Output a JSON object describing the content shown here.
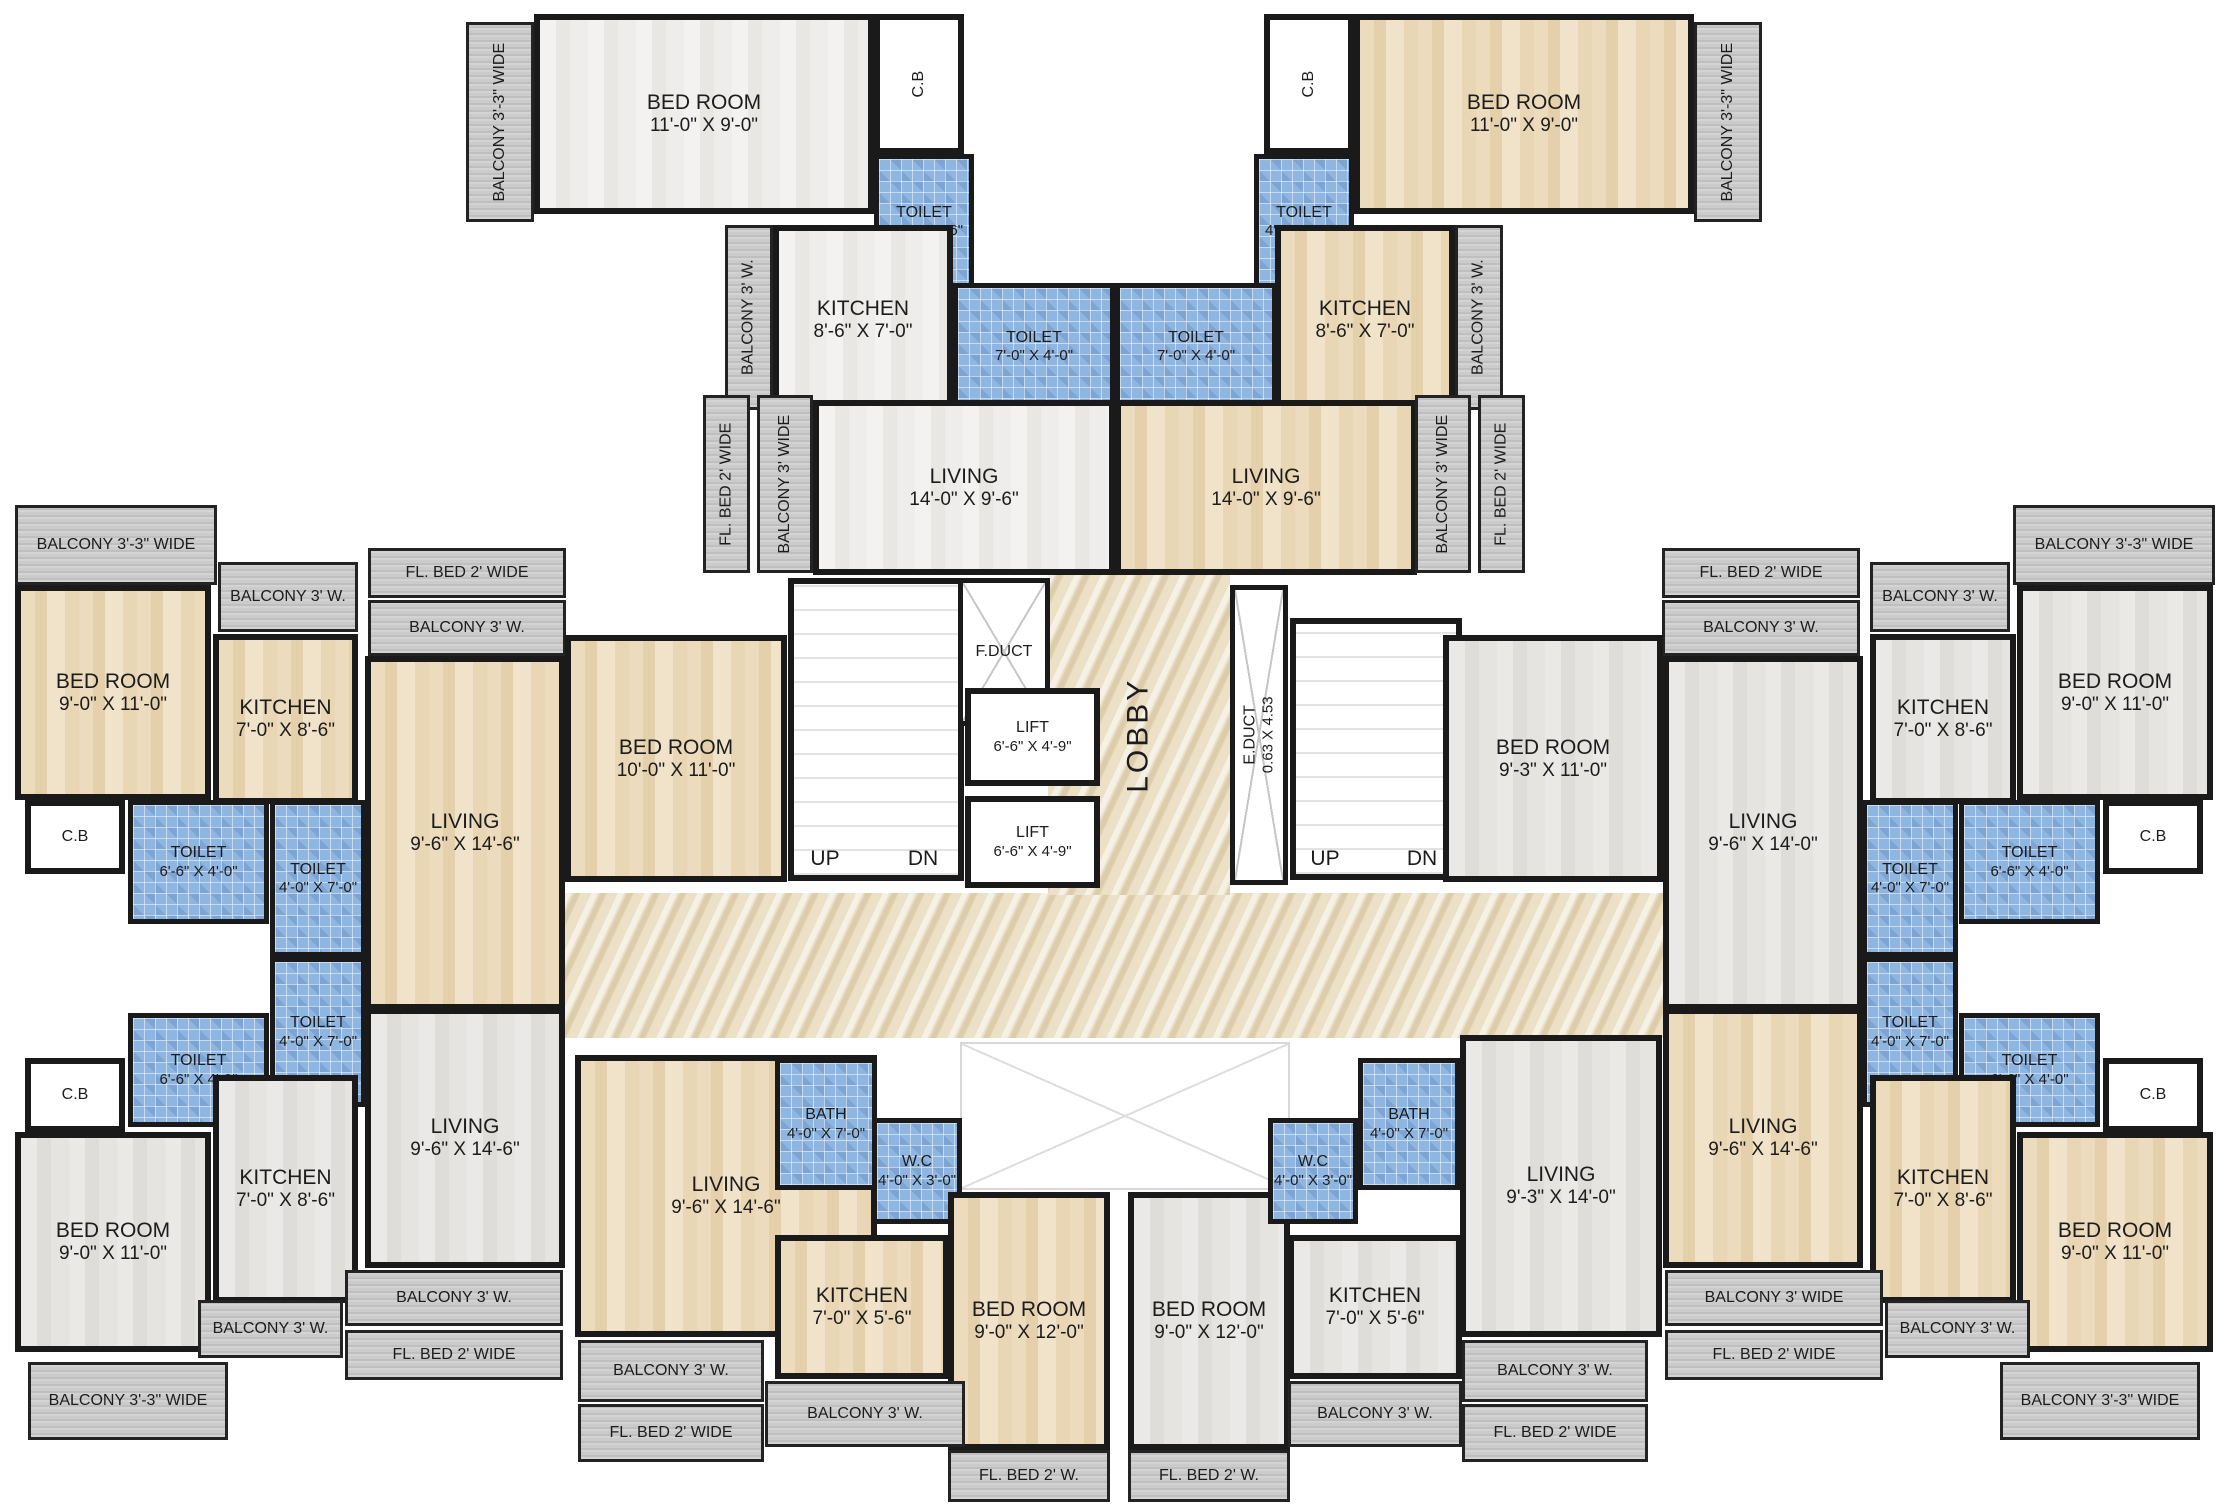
{
  "plan": {
    "width": 2229,
    "height": 1509,
    "type": "residential-building-floor-plan"
  },
  "colors": {
    "wall": "#1a1a1a",
    "wood_floor": "#e8d6b4",
    "tile_light_floor": "#eeedea",
    "tile_gray_floor": "#e4e2df",
    "toilet_blue": "#8fb6e0",
    "balcony_gray": "#c6c6c6",
    "lobby_marble": "#ece0c6"
  },
  "rooms": [
    {
      "name": "lobby-corridor",
      "label": "",
      "dims": "",
      "x": 565,
      "y": 893,
      "w": 1100,
      "h": 145,
      "floor": "marble"
    },
    {
      "name": "lobby",
      "label": "LOBBY",
      "dims": "",
      "x": 1048,
      "y": 575,
      "w": 182,
      "h": 320,
      "floor": "marble",
      "rot": true,
      "size": "lob"
    },
    {
      "name": "staircase-left",
      "label": "",
      "dims": "",
      "x": 788,
      "y": 578,
      "w": 176,
      "h": 303,
      "floor": "stairs"
    },
    {
      "name": "staircase-right",
      "label": "",
      "dims": "",
      "x": 1290,
      "y": 618,
      "w": 172,
      "h": 262,
      "floor": "stairs"
    },
    {
      "name": "f-duct",
      "label": "F.DUCT",
      "dims": "",
      "x": 958,
      "y": 578,
      "w": 92,
      "h": 148,
      "floor": "duct",
      "size": "sm"
    },
    {
      "name": "e-duct",
      "label": "E.DUCT",
      "dims": "0.63 X 4.53",
      "x": 1230,
      "y": 585,
      "w": 58,
      "h": 300,
      "floor": "duct",
      "rot": true,
      "size": "sm"
    },
    {
      "name": "open-cut",
      "label": "",
      "dims": "",
      "x": 960,
      "y": 1042,
      "w": 330,
      "h": 148,
      "floor": "void"
    },
    {
      "name": "lift-1",
      "label": "LIFT",
      "dims": "6'-6\" X 4'-9\"",
      "x": 965,
      "y": 688,
      "w": 135,
      "h": 98,
      "floor": "white",
      "size": "sm"
    },
    {
      "name": "lift-2",
      "label": "LIFT",
      "dims": "6'-6\" X 4'-9\"",
      "x": 965,
      "y": 796,
      "w": 135,
      "h": 92,
      "floor": "white",
      "size": "sm"
    },
    {
      "name": "balcony-33-top-left",
      "label": "BALCONY 3'-3\" WIDE",
      "dims": "",
      "x": 466,
      "y": 22,
      "w": 68,
      "h": 200,
      "floor": "balc",
      "rot": true,
      "size": "sm"
    },
    {
      "name": "bedroom-top-left",
      "label": "BED ROOM",
      "dims": "11'-0\" X 9'-0\"",
      "x": 534,
      "y": 14,
      "w": 340,
      "h": 200,
      "floor": "tileLight"
    },
    {
      "name": "cb-top-left",
      "label": "C.B",
      "dims": "",
      "x": 874,
      "y": 14,
      "w": 90,
      "h": 140,
      "floor": "white",
      "rot": true,
      "size": "sm"
    },
    {
      "name": "toilet-46-top-left",
      "label": "TOILET",
      "dims": "4'-0\" X 6'-6\"",
      "x": 874,
      "y": 154,
      "w": 100,
      "h": 135,
      "floor": "blue",
      "size": "sm"
    },
    {
      "name": "balcony-3w-top-left",
      "label": "BALCONY 3' W.",
      "dims": "",
      "x": 725,
      "y": 225,
      "w": 48,
      "h": 185,
      "floor": "balc",
      "rot": true,
      "size": "sm"
    },
    {
      "name": "kitchen-top-left",
      "label": "KITCHEN",
      "dims": "8'-6\" X 7'-0\"",
      "x": 773,
      "y": 225,
      "w": 180,
      "h": 190,
      "floor": "tileLight"
    },
    {
      "name": "toilet-74-top-left",
      "label": "TOILET",
      "dims": "7'-0\" X 4'-0\"",
      "x": 953,
      "y": 283,
      "w": 162,
      "h": 127,
      "floor": "blue",
      "size": "sm"
    },
    {
      "name": "flbed-top-left",
      "label": "FL. BED 2' WIDE",
      "dims": "",
      "x": 703,
      "y": 395,
      "w": 47,
      "h": 178,
      "floor": "balc",
      "rot": true,
      "size": "sm"
    },
    {
      "name": "balcony-3wide-top-left",
      "label": "BALCONY 3' WIDE",
      "dims": "",
      "x": 757,
      "y": 395,
      "w": 56,
      "h": 178,
      "floor": "balc",
      "rot": true,
      "size": "sm"
    },
    {
      "name": "living-top-left",
      "label": "LIVING",
      "dims": "14'-0\" X 9'-6\"",
      "x": 813,
      "y": 400,
      "w": 302,
      "h": 175,
      "floor": "tileLight"
    },
    {
      "name": "toilet-46-top-right",
      "label": "TOILET",
      "dims": "4'-0\" X 6'-6\"",
      "x": 1254,
      "y": 154,
      "w": 100,
      "h": 135,
      "floor": "blue",
      "size": "sm"
    },
    {
      "name": "cb-top-right",
      "label": "C.B",
      "dims": "",
      "x": 1264,
      "y": 14,
      "w": 90,
      "h": 140,
      "floor": "white",
      "rot": true,
      "size": "sm"
    },
    {
      "name": "bedroom-top-right",
      "label": "BED ROOM",
      "dims": "11'-0\" X 9'-0\"",
      "x": 1354,
      "y": 14,
      "w": 340,
      "h": 200,
      "floor": "wood"
    },
    {
      "name": "balcony-33-top-right",
      "label": "BALCONY 3'-3\" WIDE",
      "dims": "",
      "x": 1694,
      "y": 22,
      "w": 68,
      "h": 200,
      "floor": "balc",
      "rot": true,
      "size": "sm"
    },
    {
      "name": "toilet-74-top-right",
      "label": "TOILET",
      "dims": "7'-0\" X 4'-0\"",
      "x": 1115,
      "y": 283,
      "w": 162,
      "h": 127,
      "floor": "blue",
      "size": "sm"
    },
    {
      "name": "kitchen-top-right",
      "label": "KITCHEN",
      "dims": "8'-6\" X 7'-0\"",
      "x": 1275,
      "y": 225,
      "w": 180,
      "h": 190,
      "floor": "wood"
    },
    {
      "name": "balcony-3w-top-right",
      "label": "BALCONY 3' W.",
      "dims": "",
      "x": 1455,
      "y": 225,
      "w": 48,
      "h": 185,
      "floor": "balc",
      "rot": true,
      "size": "sm"
    },
    {
      "name": "living-top-right",
      "label": "LIVING",
      "dims": "14'-0\" X 9'-6\"",
      "x": 1115,
      "y": 400,
      "w": 302,
      "h": 175,
      "floor": "wood"
    },
    {
      "name": "balcony-3wide-top-right",
      "label": "BALCONY 3' WIDE",
      "dims": "",
      "x": 1415,
      "y": 395,
      "w": 56,
      "h": 178,
      "floor": "balc",
      "rot": true,
      "size": "sm"
    },
    {
      "name": "flbed-top-right",
      "label": "FL. BED 2' WIDE",
      "dims": "",
      "x": 1478,
      "y": 395,
      "w": 47,
      "h": 178,
      "floor": "balc",
      "rot": true,
      "size": "sm"
    },
    {
      "name": "balcony-33-left-top",
      "label": "BALCONY 3'-3\"  WIDE",
      "dims": "",
      "x": 15,
      "y": 505,
      "w": 202,
      "h": 80,
      "floor": "balc",
      "size": "sm"
    },
    {
      "name": "balcony-3w-left-top",
      "label": "BALCONY 3' W.",
      "dims": "",
      "x": 218,
      "y": 562,
      "w": 140,
      "h": 70,
      "floor": "balc",
      "size": "sm"
    },
    {
      "name": "flbed-left-top",
      "label": "FL. BED 2'  WIDE",
      "dims": "",
      "x": 368,
      "y": 548,
      "w": 198,
      "h": 50,
      "floor": "balc",
      "size": "sm"
    },
    {
      "name": "balcony-3w-left-top-2",
      "label": "BALCONY 3' W.",
      "dims": "",
      "x": 368,
      "y": 600,
      "w": 198,
      "h": 56,
      "floor": "balc",
      "size": "sm"
    },
    {
      "name": "bedroom-left-top",
      "label": "BED ROOM",
      "dims": "9'-0\" X 11'-0\"",
      "x": 15,
      "y": 585,
      "w": 196,
      "h": 215,
      "floor": "wood"
    },
    {
      "name": "kitchen-left-top",
      "label": "KITCHEN",
      "dims": "7'-0\" X 8'-6\"",
      "x": 213,
      "y": 634,
      "w": 145,
      "h": 170,
      "floor": "wood"
    },
    {
      "name": "living-left-mid",
      "label": "LIVING",
      "dims": "9'-6\" X 14'-6\"",
      "x": 365,
      "y": 656,
      "w": 200,
      "h": 354,
      "floor": "wood"
    },
    {
      "name": "bedroom-10x11-left-mid",
      "label": "BED ROOM",
      "dims": "10'-0\" X 11'-0\"",
      "x": 565,
      "y": 635,
      "w": 222,
      "h": 247,
      "floor": "wood"
    },
    {
      "name": "cb-left-top",
      "label": "C.B",
      "dims": "",
      "x": 25,
      "y": 800,
      "w": 100,
      "h": 74,
      "floor": "white",
      "size": "sm"
    },
    {
      "name": "toilet-66-left-top",
      "label": "TOILET",
      "dims": "6'-6\" X 4'-0\"",
      "x": 128,
      "y": 800,
      "w": 141,
      "h": 124,
      "floor": "blue",
      "size": "sm"
    },
    {
      "name": "toilet-47-left-top",
      "label": "TOILET",
      "dims": "4'-0\" X 7'-0\"",
      "x": 270,
      "y": 800,
      "w": 96,
      "h": 157,
      "floor": "blue",
      "size": "sm"
    },
    {
      "name": "toilet-47-left-bot",
      "label": "TOILET",
      "dims": "4'-0\" X 7'-0\"",
      "x": 270,
      "y": 957,
      "w": 96,
      "h": 150,
      "floor": "blue",
      "size": "sm"
    },
    {
      "name": "toilet-66-left-bot",
      "label": "TOILET",
      "dims": "6'-6\" X 4'-0\"",
      "x": 128,
      "y": 1013,
      "w": 141,
      "h": 114,
      "floor": "blue",
      "size": "sm"
    },
    {
      "name": "cb-left-bot",
      "label": "C.B",
      "dims": "",
      "x": 25,
      "y": 1058,
      "w": 100,
      "h": 74,
      "floor": "white",
      "size": "sm"
    },
    {
      "name": "bedroom-left-bot",
      "label": "BED ROOM",
      "dims": "9'-0\" X 11'-0\"",
      "x": 15,
      "y": 1132,
      "w": 196,
      "h": 220,
      "floor": "tileGray"
    },
    {
      "name": "kitchen-left-bot",
      "label": "KITCHEN",
      "dims": "7'-0\" X 8'-6\"",
      "x": 213,
      "y": 1075,
      "w": 145,
      "h": 228,
      "floor": "tileGray"
    },
    {
      "name": "living-left-bot",
      "label": "LIVING",
      "dims": "9'-6\" X 14'-6\"",
      "x": 365,
      "y": 1008,
      "w": 200,
      "h": 260,
      "floor": "tileGray"
    },
    {
      "name": "balcony-3wide-left-bot",
      "label": "BALCONY 3' W.",
      "dims": "",
      "x": 345,
      "y": 1270,
      "w": 218,
      "h": 56,
      "floor": "balc",
      "size": "sm"
    },
    {
      "name": "flbed-left-bot",
      "label": "FL. BED 2' WIDE",
      "dims": "",
      "x": 345,
      "y": 1330,
      "w": 218,
      "h": 50,
      "floor": "balc",
      "size": "sm"
    },
    {
      "name": "balcony-3w-left-bot-2",
      "label": "BALCONY 3' W.",
      "dims": "",
      "x": 198,
      "y": 1300,
      "w": 145,
      "h": 58,
      "floor": "balc",
      "size": "sm"
    },
    {
      "name": "balcony-33-left-bot",
      "label": "BALCONY 3'-3\"  WIDE",
      "dims": "",
      "x": 28,
      "y": 1362,
      "w": 200,
      "h": 78,
      "floor": "balc",
      "size": "sm"
    },
    {
      "name": "living-bot-left",
      "label": "LIVING",
      "dims": "9'-6\" X 14'-6\"",
      "x": 575,
      "y": 1055,
      "w": 302,
      "h": 282,
      "floor": "wood"
    },
    {
      "name": "bath-bot-left",
      "label": "BATH",
      "dims": "4'-0\" X 7'-0\"",
      "x": 775,
      "y": 1058,
      "w": 102,
      "h": 132,
      "floor": "blue",
      "size": "sm"
    },
    {
      "name": "wc-bot-left",
      "label": "W.C",
      "dims": "4'-0\" X 3'-0\"",
      "x": 872,
      "y": 1118,
      "w": 90,
      "h": 106,
      "floor": "blue",
      "size": "sm"
    },
    {
      "name": "kitchen-bot-left",
      "label": "KITCHEN",
      "dims": "7'-0\" X 5'-6\"",
      "x": 775,
      "y": 1235,
      "w": 174,
      "h": 144,
      "floor": "wood"
    },
    {
      "name": "bedroom-12-bot-left",
      "label": "BED ROOM",
      "dims": "9'-0\" X 12'-0\"",
      "x": 948,
      "y": 1192,
      "w": 162,
      "h": 258,
      "floor": "wood"
    },
    {
      "name": "balcony-3w-bot-left",
      "label": "BALCONY 3' W.",
      "dims": "",
      "x": 578,
      "y": 1340,
      "w": 186,
      "h": 62,
      "floor": "balc",
      "size": "sm"
    },
    {
      "name": "flbed-bot-left",
      "label": "FL. BED 2' WIDE",
      "dims": "",
      "x": 578,
      "y": 1404,
      "w": 186,
      "h": 58,
      "floor": "balc",
      "size": "sm"
    },
    {
      "name": "balcony-3w-bot-center-left",
      "label": "BALCONY 3' W.",
      "dims": "",
      "x": 765,
      "y": 1381,
      "w": 200,
      "h": 66,
      "floor": "balc",
      "size": "sm"
    },
    {
      "name": "flbed-bot-center-left",
      "label": "FL. BED 2' W.",
      "dims": "",
      "x": 948,
      "y": 1450,
      "w": 162,
      "h": 52,
      "floor": "balc",
      "size": "sm"
    },
    {
      "name": "bedroom-12-bot-right",
      "label": "BED ROOM",
      "dims": "9'-0\" X 12'-0\"",
      "x": 1128,
      "y": 1192,
      "w": 162,
      "h": 258,
      "floor": "tileGray"
    },
    {
      "name": "wc-bot-right",
      "label": "W.C",
      "dims": "4'-0\" X 3'-0\"",
      "x": 1268,
      "y": 1118,
      "w": 90,
      "h": 106,
      "floor": "blue",
      "size": "sm"
    },
    {
      "name": "bath-bot-right",
      "label": "BATH",
      "dims": "4'-0\" X 7'-0\"",
      "x": 1358,
      "y": 1058,
      "w": 102,
      "h": 132,
      "floor": "blue",
      "size": "sm"
    },
    {
      "name": "kitchen-bot-right",
      "label": "KITCHEN",
      "dims": "7'-0\" X 5'-6\"",
      "x": 1288,
      "y": 1235,
      "w": 174,
      "h": 144,
      "floor": "tileGray"
    },
    {
      "name": "living-bot-right",
      "label": "LIVING",
      "dims": "9'-3\" X 14'-0\"",
      "x": 1460,
      "y": 1035,
      "w": 202,
      "h": 302,
      "floor": "tileGray"
    },
    {
      "name": "flbed-bot-center-right",
      "label": "FL. BED 2' W.",
      "dims": "",
      "x": 1128,
      "y": 1450,
      "w": 162,
      "h": 52,
      "floor": "balc",
      "size": "sm"
    },
    {
      "name": "balcony-3w-bot-center-right",
      "label": "BALCONY 3' W.",
      "dims": "",
      "x": 1288,
      "y": 1381,
      "w": 174,
      "h": 66,
      "floor": "balc",
      "size": "sm"
    },
    {
      "name": "balcony-3w-bot-right",
      "label": "BALCONY 3' W.",
      "dims": "",
      "x": 1462,
      "y": 1340,
      "w": 186,
      "h": 62,
      "floor": "balc",
      "size": "sm"
    },
    {
      "name": "flbed-bot-right",
      "label": "FL. BED 2' WIDE",
      "dims": "",
      "x": 1462,
      "y": 1404,
      "w": 186,
      "h": 58,
      "floor": "balc",
      "size": "sm"
    },
    {
      "name": "flbed-right-top",
      "label": "FL. BED 2' WIDE",
      "dims": "",
      "x": 1662,
      "y": 548,
      "w": 198,
      "h": 50,
      "floor": "balc",
      "size": "sm"
    },
    {
      "name": "balcony-3w-right-top-2",
      "label": "BALCONY 3' W.",
      "dims": "",
      "x": 1662,
      "y": 600,
      "w": 198,
      "h": 56,
      "floor": "balc",
      "size": "sm"
    },
    {
      "name": "balcony-3w-right-top",
      "label": "BALCONY 3' W.",
      "dims": "",
      "x": 1870,
      "y": 562,
      "w": 140,
      "h": 70,
      "floor": "balc",
      "size": "sm"
    },
    {
      "name": "balcony-33-right-top",
      "label": "BALCONY 3'-3\"  WIDE",
      "dims": "",
      "x": 2013,
      "y": 505,
      "w": 202,
      "h": 80,
      "floor": "balc",
      "size": "sm"
    },
    {
      "name": "bedroom-93-right-mid",
      "label": "BED ROOM",
      "dims": "9'-3\" X 11'-0\"",
      "x": 1443,
      "y": 635,
      "w": 220,
      "h": 247,
      "floor": "tileGray"
    },
    {
      "name": "living-right-mid",
      "label": "LIVING",
      "dims": "9'-6\" X 14'-0\"",
      "x": 1663,
      "y": 656,
      "w": 200,
      "h": 354,
      "floor": "tileGray"
    },
    {
      "name": "kitchen-right-top",
      "label": "KITCHEN",
      "dims": "7'-0\" X 8'-6\"",
      "x": 1870,
      "y": 634,
      "w": 146,
      "h": 170,
      "floor": "tileGray"
    },
    {
      "name": "bedroom-right-top",
      "label": "BED ROOM",
      "dims": "9'-0\" X 11'-0\"",
      "x": 2017,
      "y": 585,
      "w": 196,
      "h": 215,
      "floor": "tileGray"
    },
    {
      "name": "toilet-47-right-top",
      "label": "TOILET",
      "dims": "4'-0\" X 7'-0\"",
      "x": 1862,
      "y": 800,
      "w": 96,
      "h": 157,
      "floor": "blue",
      "size": "sm"
    },
    {
      "name": "toilet-66-right-top",
      "label": "TOILET",
      "dims": "6'-6\" X 4'-0\"",
      "x": 1959,
      "y": 800,
      "w": 141,
      "h": 124,
      "floor": "blue",
      "size": "sm"
    },
    {
      "name": "cb-right-top",
      "label": "C.B",
      "dims": "",
      "x": 2103,
      "y": 800,
      "w": 100,
      "h": 74,
      "floor": "white",
      "size": "sm"
    },
    {
      "name": "toilet-47-right-bot",
      "label": "TOILET",
      "dims": "4'-0\" X 7'-0\"",
      "x": 1862,
      "y": 957,
      "w": 96,
      "h": 150,
      "floor": "blue",
      "size": "sm"
    },
    {
      "name": "toilet-66-right-bot",
      "label": "TOILET",
      "dims": "6'-6\" X 4'-0\"",
      "x": 1959,
      "y": 1013,
      "w": 141,
      "h": 114,
      "floor": "blue",
      "size": "sm"
    },
    {
      "name": "cb-right-bot",
      "label": "C.B",
      "dims": "",
      "x": 2103,
      "y": 1058,
      "w": 100,
      "h": 74,
      "floor": "white",
      "size": "sm"
    },
    {
      "name": "living-right-bot",
      "label": "LIVING",
      "dims": "9'-6\" X 14'-6\"",
      "x": 1663,
      "y": 1008,
      "w": 200,
      "h": 260,
      "floor": "wood"
    },
    {
      "name": "kitchen-right-bot",
      "label": "KITCHEN",
      "dims": "7'-0\" X 8'-6\"",
      "x": 1870,
      "y": 1075,
      "w": 146,
      "h": 228,
      "floor": "wood"
    },
    {
      "name": "bedroom-right-bot",
      "label": "BED ROOM",
      "dims": "9'-0\" X 11'-0\"",
      "x": 2017,
      "y": 1132,
      "w": 196,
      "h": 220,
      "floor": "wood"
    },
    {
      "name": "balcony-3wide-right-bot",
      "label": "BALCONY  3' WIDE",
      "dims": "",
      "x": 1665,
      "y": 1270,
      "w": 218,
      "h": 56,
      "floor": "balc",
      "size": "sm"
    },
    {
      "name": "flbed-right-bot",
      "label": "FL. BED 2' WIDE",
      "dims": "",
      "x": 1665,
      "y": 1330,
      "w": 218,
      "h": 50,
      "floor": "balc",
      "size": "sm"
    },
    {
      "name": "balcony-3w-right-bot-2",
      "label": "BALCONY 3' W.",
      "dims": "",
      "x": 1885,
      "y": 1300,
      "w": 145,
      "h": 58,
      "floor": "balc",
      "size": "sm"
    },
    {
      "name": "balcony-33-right-bot",
      "label": "BALCONY 3'-3\"  WIDE",
      "dims": "",
      "x": 2000,
      "y": 1362,
      "w": 200,
      "h": 78,
      "floor": "balc",
      "size": "sm"
    },
    {
      "name": "stairs-up-left",
      "label": "UP",
      "dims": "",
      "x": 795,
      "y": 842,
      "w": 60,
      "h": 34,
      "floor": "none",
      "size": "md"
    },
    {
      "name": "stairs-dn-left",
      "label": "DN",
      "dims": "",
      "x": 893,
      "y": 842,
      "w": 60,
      "h": 34,
      "floor": "none",
      "size": "md"
    },
    {
      "name": "stairs-up-right",
      "label": "UP",
      "dims": "",
      "x": 1295,
      "y": 842,
      "w": 60,
      "h": 34,
      "floor": "none",
      "size": "md"
    },
    {
      "name": "stairs-dn-right",
      "label": "DN",
      "dims": "",
      "x": 1392,
      "y": 842,
      "w": 60,
      "h": 34,
      "floor": "none",
      "size": "md"
    }
  ]
}
